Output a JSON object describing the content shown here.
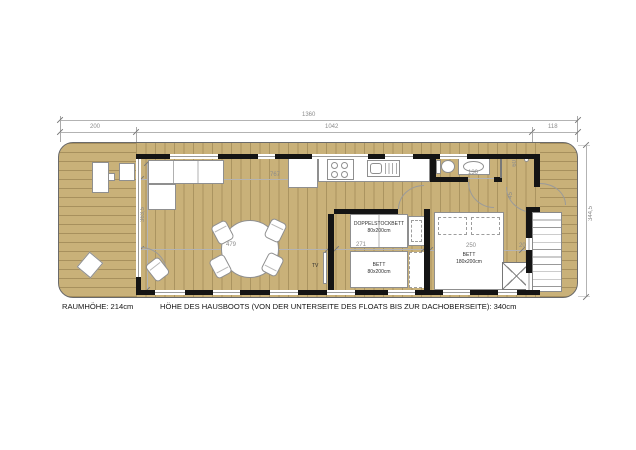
{
  "title": "Hausboot Grundriss",
  "dimensions": {
    "top_total": "1360",
    "top_bow": "200",
    "top_cabin": "1042",
    "top_stern": "118",
    "right_width": "344,5",
    "front_glazing": "363,5",
    "kitchen_living": "767",
    "living": "479",
    "bath": "130",
    "shower": "60",
    "entry": "45",
    "kids_room": "271",
    "master_room": "250",
    "stair_gap": "20"
  },
  "rooms": {
    "bunk_bed_line1": "DOPPELSTOCKBETT",
    "bunk_bed_line2": "80x200cm",
    "single_bed_line1": "BETT",
    "single_bed_line2": "80x200cm",
    "double_bed_line1": "BETT",
    "double_bed_line2": "180x200cm",
    "tv": "TV"
  },
  "caption": {
    "room_height": "RAUMHÖHE: 214cm",
    "boat_height": "HÖHE DES HAUSBOOTS (VON DER UNTERSEITE DES FLOATS BIS ZUR DACHOBERSEITE): 340cm"
  },
  "colors": {
    "floor": "#C9B179",
    "wall": "#141414",
    "fixture": "#FFFFFF",
    "dim": "#8C8C8C"
  }
}
